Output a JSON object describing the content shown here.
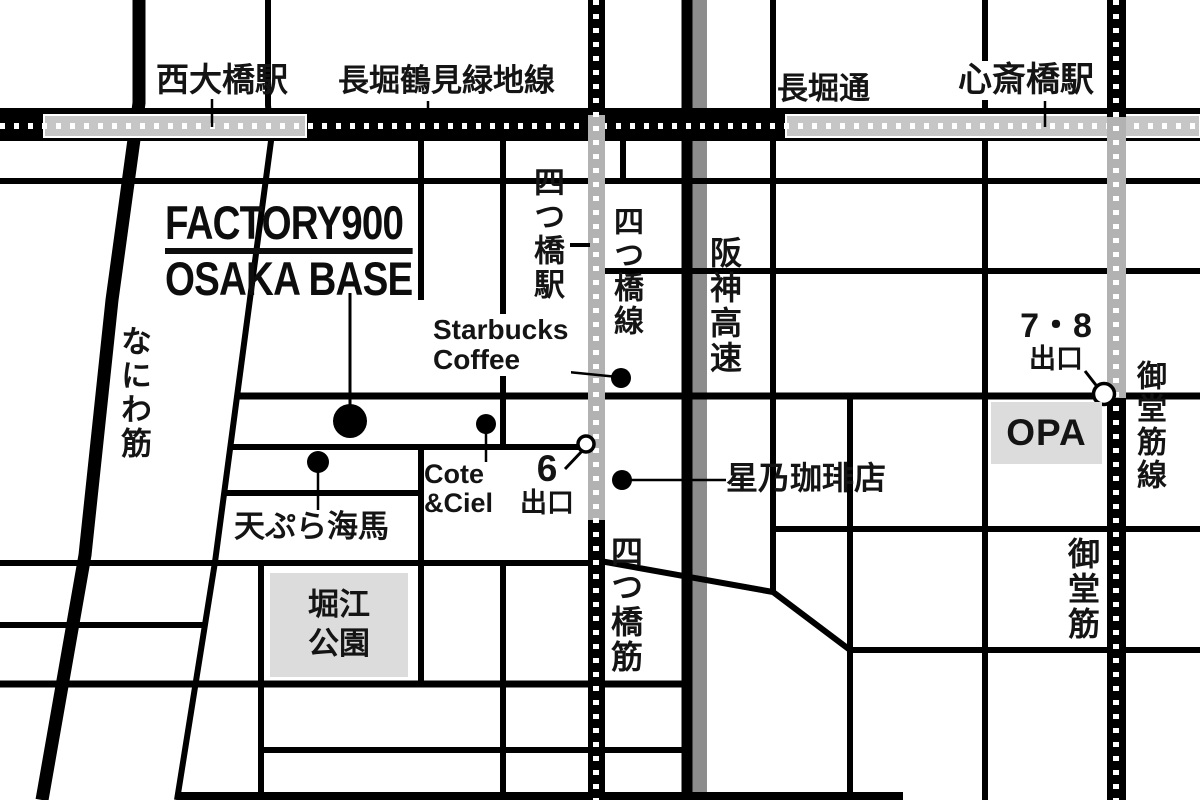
{
  "map": {
    "logo": {
      "line1": "FACTORY900",
      "line2": "OSAKA BASE"
    },
    "stations": {
      "nishiohashi": "西大橋駅",
      "shinsaibashi": "心斎橋駅",
      "yotsubashi": "四つ橋駅"
    },
    "lines": {
      "nagahori_tsurumiryokuchi": "長堀鶴見緑地線",
      "yotsubashi": "四つ橋線",
      "midosuji": "御堂筋線"
    },
    "roads": {
      "nagahori_dori": "長堀通",
      "hanshin_expressway": "阪神高速",
      "naniwa_suji": "なにわ筋",
      "yotsubashi_suji": "四つ橋筋",
      "midosuji": "御堂筋"
    },
    "pois": {
      "starbucks_line1": "Starbucks",
      "starbucks_line2": "Coffee",
      "cote_line1": "Cote",
      "cote_line2": "&Ciel",
      "hoshino": "星乃珈琲店",
      "tempura": "天ぷら海馬",
      "opa": "OPA",
      "horie_line1": "堀江",
      "horie_line2": "公園"
    },
    "exits": {
      "exit78_line1": "7・8",
      "exit78_line2": "出口",
      "exit6_line1": "6",
      "exit6_line2": "出口"
    }
  },
  "colors": {
    "road": "#000000",
    "expressway_gray": "#8c8c8c",
    "station_box_gray": "#c6c6c6",
    "subway_station_gray": "#b2b2b2",
    "poi_box_gray": "#dcdcdc",
    "background": "#ffffff",
    "marker_dot": "#000000",
    "exit_marker_fill": "#ffffff"
  }
}
